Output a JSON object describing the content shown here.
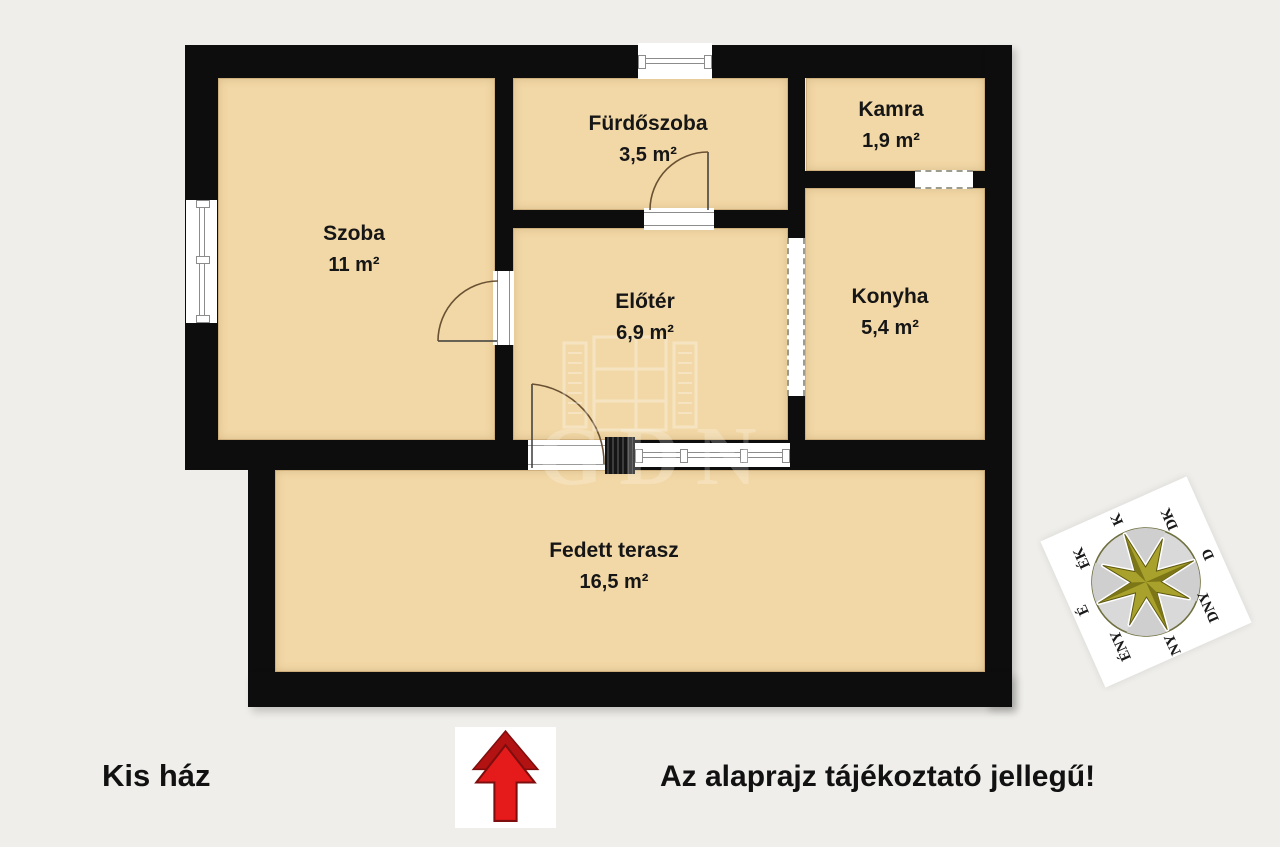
{
  "title": "Kis ház",
  "disclaimer": "Az alaprajz tájékoztató jellegű!",
  "watermark": "GDN",
  "rooms": {
    "szoba": {
      "name": "Szoba",
      "area": "11 m²"
    },
    "furdo": {
      "name": "Fürdőszoba",
      "area": "3,5 m²"
    },
    "kamra": {
      "name": "Kamra",
      "area": "1,9 m²"
    },
    "eloter": {
      "name": "Előtér",
      "area": "6,9 m²"
    },
    "konyha": {
      "name": "Konyha",
      "area": "5,4 m²"
    },
    "terasz": {
      "name": "Fedett terasz",
      "area": "16,5 m²"
    }
  },
  "compass": {
    "n": "É",
    "ne": "ÉK",
    "e": "K",
    "se": "DK",
    "s": "D",
    "sw": "DNY",
    "w": "NY",
    "nw": "ÉNY"
  },
  "colors": {
    "background": "#efeeea",
    "floor": "#f2d8a6",
    "wall": "#0d0d0d",
    "accent_red": "#e51a1a",
    "compass_star": "#a8a12b"
  }
}
